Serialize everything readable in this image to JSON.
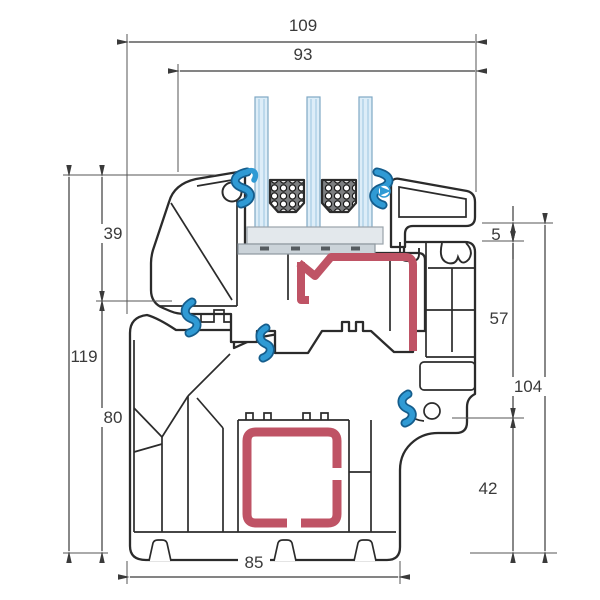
{
  "drawing": {
    "kind": "window-profile-cross-section",
    "dimensions": {
      "top_total": "109",
      "top_glazing": "93",
      "left_upper": "39",
      "left_total": "119",
      "left_lower": "80",
      "right_gap": "5",
      "right_upper": "57",
      "right_total": "104",
      "right_lower": "42",
      "bottom_frame": "85"
    },
    "colors": {
      "outline": "#2b2b2b",
      "dimension_line": "#3a3a3a",
      "steel_red": "#bf5365",
      "gasket_blue": "#2f9ad4",
      "gasket_blue_dark": "#155d8c",
      "glass_blue": "#ddedf8",
      "glass_stripe": "#bcd9ec",
      "spacer_gray": "#7d7f81",
      "setting_block_light": "#e3e8ec",
      "setting_block_dark": "#cbd3d9"
    }
  }
}
